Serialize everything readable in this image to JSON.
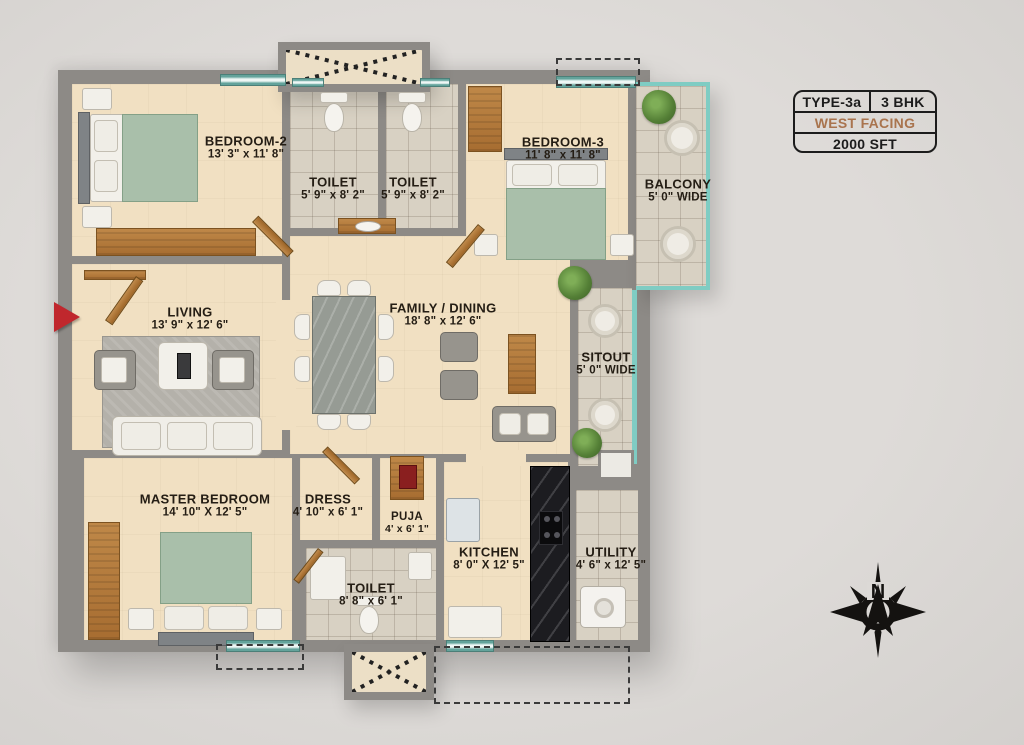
{
  "plan": {
    "title_badge": {
      "type": "TYPE-3a",
      "bhk": "3 BHK",
      "facing": "WEST FACING",
      "area": "2000 SFT"
    },
    "compass": {
      "north_label": "N"
    },
    "rooms": [
      {
        "id": "bedroom2",
        "name": "BEDROOM-2",
        "dims": "13' 3\" x 11' 8\""
      },
      {
        "id": "toilet1",
        "name": "TOILET",
        "dims": "5' 9\" x 8' 2\""
      },
      {
        "id": "toilet2",
        "name": "TOILET",
        "dims": "5' 9\" x 8' 2\""
      },
      {
        "id": "bedroom3",
        "name": "BEDROOM-3",
        "dims": "11' 8\" x 11' 8\""
      },
      {
        "id": "balcony",
        "name": "BALCONY",
        "dims": "5' 0\" WIDE"
      },
      {
        "id": "living",
        "name": "LIVING",
        "dims": "13' 9\" x 12' 6\""
      },
      {
        "id": "family_dining",
        "name": "FAMILY / DINING",
        "dims": "18' 8\" x 12' 6\""
      },
      {
        "id": "sitout",
        "name": "SITOUT",
        "dims": "5' 0\" WIDE"
      },
      {
        "id": "master_bedroom",
        "name": "MASTER BEDROOM",
        "dims": "14' 10\" X 12' 5\""
      },
      {
        "id": "dress",
        "name": "DRESS",
        "dims": "4' 10\" x 6' 1\""
      },
      {
        "id": "puja",
        "name": "PUJA",
        "dims": "4' x 6' 1\""
      },
      {
        "id": "toilet3",
        "name": "TOILET",
        "dims": "8' 8\" x 6' 1\""
      },
      {
        "id": "kitchen",
        "name": "KITCHEN",
        "dims": "8' 0\" X 12' 5\""
      },
      {
        "id": "utility",
        "name": "UTILITY",
        "dims": "4' 6\" x 12' 5\""
      }
    ],
    "colors": {
      "wall": "#8d8a86",
      "floor_beige": "#f1e0c2",
      "floor_tile": "#d8d1c3",
      "glass_teal": "#7fccc3",
      "entrance_arrow_red": "#c0272d",
      "facing_text": "#a9744e",
      "badge_border": "#1c1c1c"
    }
  }
}
